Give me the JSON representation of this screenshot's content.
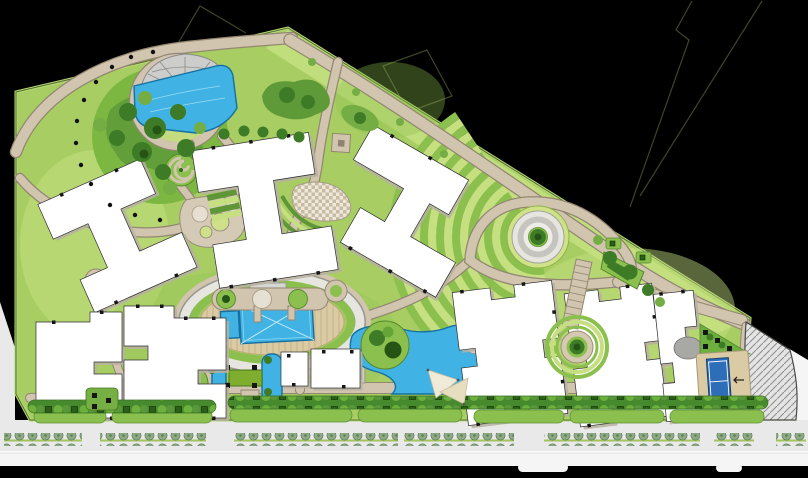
{
  "drawing": {
    "type": "Residential landscape master plan",
    "view": "top-down site plan rendering",
    "text_visible": false
  },
  "palette": {
    "background": "#000000",
    "boundary_line": "#3f4526",
    "lawn": "#a8ce63",
    "lawn_light": "#c6e081",
    "lawn_mid": "#8cc04e",
    "lawn_dark": "#5f9637",
    "foliage": "#3d7b27",
    "foliage_dark": "#265415",
    "path": "#d1c5b0",
    "path_edge": "#938772",
    "plaza": "#e7e5e0",
    "plaza_mid": "#c6c4bf",
    "deck": "#dbcba4",
    "deck_line": "#c0aa7c",
    "water": "#41b2e4",
    "water_dark": "#16709f",
    "water_light": "#9adcf2",
    "building": "#ffffff",
    "building_shadow": "#b7b0a1",
    "outline": "#2f2f2f",
    "road": "#e9e9e9",
    "road_light": "#f5f5f5",
    "median": "#a3c35c",
    "street_tree": "#8cab85",
    "street_tree_dark": "#5f7d59",
    "hedge": "#478a2d",
    "hedge_mid": "#59973a",
    "hedge_light": "#6db03e",
    "planter": "#2a5f17",
    "planter_dark": "#0e2c07",
    "court": "#2e6eb8",
    "court_line": "#ffffff",
    "checker_light": "#eee8da",
    "checker_dark": "#c7bca2",
    "gray": "#a8a8a5",
    "hatch_line": "#909090",
    "sail": "#f0ead9",
    "sail_dark": "#cbbd9e"
  },
  "features": {
    "site_parcel": "Site parcel lawn",
    "property_boundary": "Property boundary line",
    "street": "Public street",
    "street_median_trees": "Street median tree row",
    "sidewalk": "Sidewalk strip",
    "access_road": "Access road (west)",
    "service_road": "Hatched service drive",
    "perimeter_path": "Perimeter promenade",
    "garden_path": "Curved garden path",
    "ornamental_lake": "Ornamental lake",
    "fan_deck": "Fan-shaped lake deck",
    "tree_grove": "Perimeter tree grove",
    "path_lights": "Path light bollards",
    "spiral_garden": "Spiral garden walk",
    "terrace_pods": "Terraced garden pods",
    "parterre_fan": "Fan parterre with checker paving",
    "lawn_terraces": "Striped lawn terraces",
    "junction_pad": "Path junction pad",
    "mandala_garden": "Concentric ring garden",
    "mandala_plaza": "Central ring plaza with tree",
    "triangle_island": "Triangular planting island",
    "garden_steps": "Terraced garden steps",
    "courtyard_circle": "Circular courtyard garden",
    "oval_deck": "Oval pool deck",
    "pool_ring_walk": "Oval ring walkway",
    "main_pool": "Main swimming pool",
    "kids_pool": "Children's pool",
    "pool_steps": "Pool deck steps",
    "clubhouse": "Clubhouse block",
    "square_fountain": "Square fountain pool",
    "water_garden": "Water-play garden",
    "lawn_panel": "Clipped lawn panel",
    "stream_garden": "Stream water garden",
    "island_grove": "Island tree grove",
    "stepping_disc": "Round stepping terrace",
    "shade_sails": "Shade sail canopies",
    "teardrop_garden": "Teardrop topiary circle",
    "pod_walk": "Pod walkway",
    "loop_path": "Looped path with tree circles",
    "buildings": {
      "label": "Residential building block",
      "count": 8
    },
    "hedge_promenade": "Hedge promenade",
    "planter_boxes": "Square planter boxes",
    "hedge_scallops": "Clipped hedge border",
    "paver_terrace": "Grey paver terrace",
    "tennis_court": "Tennis court",
    "entry_arrow_icon": "Entry direction arrow",
    "boundary_plantings": "Boundary shrub planting"
  }
}
